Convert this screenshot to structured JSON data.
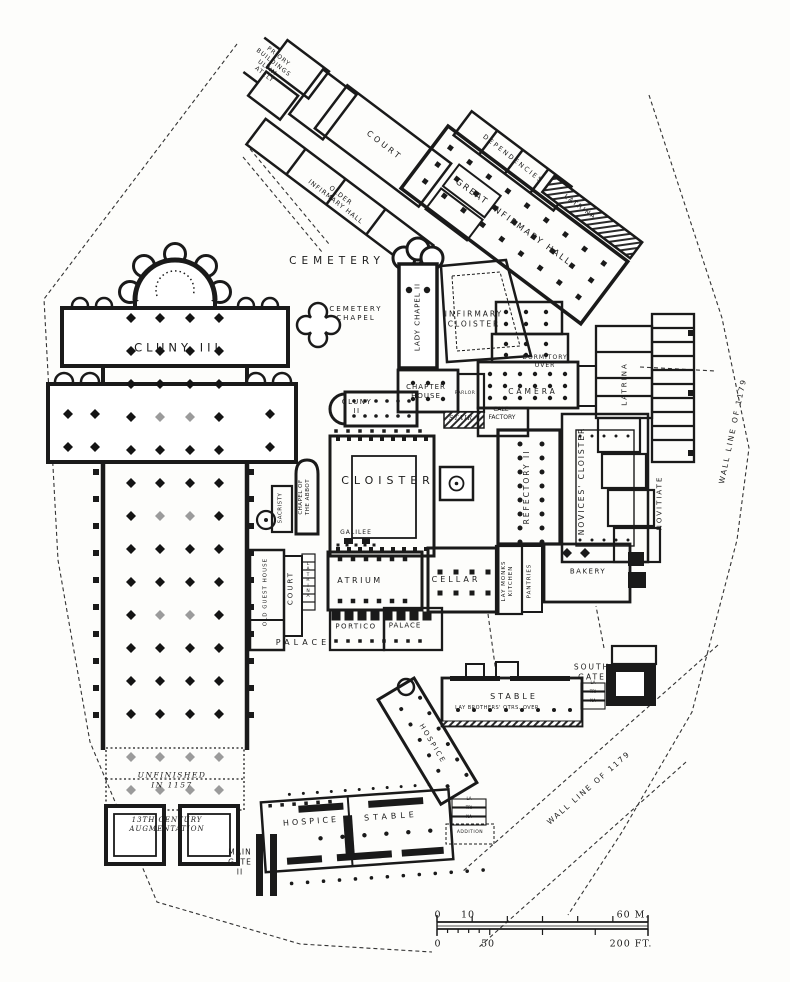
{
  "plan": {
    "type": "monastic site plan (engraved line drawing)",
    "ink_color": "#1a1a1a",
    "paper_color": "#fdfdfb"
  },
  "labels": [
    {
      "name": "priory-buildings",
      "text": "PRIORY\nBUILDINGS\nULTIM-\nATELY",
      "x": 271,
      "y": 66,
      "rot": 38,
      "size": 6,
      "ls": 1
    },
    {
      "name": "court-top",
      "text": "COURT",
      "x": 384,
      "y": 146,
      "rot": 38,
      "size": 8,
      "ls": 3
    },
    {
      "name": "older-infirmary-hall",
      "text": "OLDER\nINFIRMARY HALL",
      "x": 338,
      "y": 199,
      "rot": 38,
      "size": 6.5,
      "ls": 1
    },
    {
      "name": "dependencies",
      "text": "DEPENDENCIES",
      "x": 513,
      "y": 159,
      "rot": 38,
      "size": 6.5,
      "ls": 2
    },
    {
      "name": "latrina-top",
      "text": "LATRINA",
      "x": 580,
      "y": 207,
      "rot": 36,
      "size": 6.5,
      "ls": 1.5
    },
    {
      "name": "great-infirmary-hall",
      "text": "GREAT INFIRMARY HALL",
      "x": 513,
      "y": 223,
      "rot": 36,
      "size": 8.5,
      "ls": 2
    },
    {
      "name": "cemetery",
      "text": "CEMETERY",
      "x": 337,
      "y": 262,
      "rot": 0,
      "size": 10.5,
      "ls": 5
    },
    {
      "name": "cemetery-chapel",
      "text": "CEMETERY\nCHAPEL",
      "x": 356,
      "y": 314,
      "rot": 0,
      "size": 7,
      "ls": 2
    },
    {
      "name": "lady-chapel-ii",
      "text": "LADY CHAPEL II",
      "x": 418,
      "y": 317,
      "rot": -90,
      "size": 7,
      "ls": 1
    },
    {
      "name": "infirmary-cloister",
      "text": "INFIRMARY\nCLOISTER",
      "x": 474,
      "y": 319,
      "rot": 0,
      "size": 7.5,
      "ls": 2
    },
    {
      "name": "dormitory-over",
      "text": "DORMITORY\nOVER",
      "x": 545,
      "y": 362,
      "rot": 0,
      "size": 6,
      "ls": 1
    },
    {
      "name": "camera",
      "text": "CAMERA",
      "x": 533,
      "y": 392,
      "rot": 0,
      "size": 7.5,
      "ls": 3
    },
    {
      "name": "latrina-east",
      "text": "LATRINA",
      "x": 625,
      "y": 384,
      "rot": -90,
      "size": 7,
      "ls": 2
    },
    {
      "name": "cluny-iii",
      "text": "CLUNY III",
      "x": 178,
      "y": 348,
      "rot": 0,
      "size": 11.5,
      "ls": 4
    },
    {
      "name": "cluny-ii",
      "text": "CLUNY\nII",
      "x": 357,
      "y": 407,
      "rot": 0,
      "size": 7,
      "ls": 1.5
    },
    {
      "name": "chapter-house",
      "text": "CHAPTER\nHOUSE",
      "x": 426,
      "y": 392,
      "rot": 0,
      "size": 7,
      "ls": 1
    },
    {
      "name": "parlor",
      "text": "PARLOR",
      "x": 465,
      "y": 394,
      "rot": 0,
      "size": 4.5,
      "ls": 0.5
    },
    {
      "name": "stair",
      "text": "STAIR",
      "x": 461,
      "y": 419,
      "rot": 0,
      "size": 6,
      "ls": 1,
      "italic": true
    },
    {
      "name": "calefactory",
      "text": "CALE-\nFACTORY",
      "x": 502,
      "y": 414,
      "rot": 0,
      "size": 6,
      "ls": 0
    },
    {
      "name": "cloister",
      "text": "CLOISTER",
      "x": 388,
      "y": 481,
      "rot": 0,
      "size": 11,
      "ls": 5
    },
    {
      "name": "refectory-ii",
      "text": "REFECTORY II",
      "x": 527,
      "y": 487,
      "rot": -90,
      "size": 7.5,
      "ls": 2
    },
    {
      "name": "novices-cloister",
      "text": "NOVICES' CLOISTER",
      "x": 582,
      "y": 481,
      "rot": -90,
      "size": 7.5,
      "ls": 2
    },
    {
      "name": "novitiate",
      "text": "NOVITIATE",
      "x": 660,
      "y": 503,
      "rot": -90,
      "size": 7,
      "ls": 2
    },
    {
      "name": "sacristy",
      "text": "SACRISTY",
      "x": 281,
      "y": 508,
      "rot": -90,
      "size": 5.5,
      "ls": 0.5
    },
    {
      "name": "chapel-of-the-abbot",
      "text": "CHAPEL OF\nTHE ABBOT",
      "x": 305,
      "y": 497,
      "rot": -90,
      "size": 5.5,
      "ls": 0.5
    },
    {
      "name": "galilee",
      "text": "GALILEE",
      "x": 356,
      "y": 533,
      "rot": 0,
      "size": 6,
      "ls": 1
    },
    {
      "name": "atrium",
      "text": "ATRIUM",
      "x": 360,
      "y": 581,
      "rot": 0,
      "size": 8,
      "ls": 2.5
    },
    {
      "name": "cellar",
      "text": "CELLAR",
      "x": 456,
      "y": 580,
      "rot": 0,
      "size": 8,
      "ls": 3
    },
    {
      "name": "lay-monks-kitchen",
      "text": "LAY MONKS\nKITCHEN",
      "x": 508,
      "y": 581,
      "rot": -90,
      "size": 5.5,
      "ls": 1
    },
    {
      "name": "pantries",
      "text": "PANTRIES",
      "x": 530,
      "y": 581,
      "rot": -90,
      "size": 5.5,
      "ls": 1
    },
    {
      "name": "bakery",
      "text": "BAKERY",
      "x": 588,
      "y": 572,
      "rot": 0,
      "size": 7,
      "ls": 1.5
    },
    {
      "name": "old-guest-house",
      "text": "OLD GUEST HOUSE",
      "x": 266,
      "y": 592,
      "rot": -90,
      "size": 5.5,
      "ls": 1
    },
    {
      "name": "court-west",
      "text": "COURT",
      "x": 291,
      "y": 588,
      "rot": -90,
      "size": 7,
      "ls": 2
    },
    {
      "name": "latrina-court",
      "text": "L\nA\nT\nR\nI\nN\nA",
      "x": 308,
      "y": 581,
      "rot": 0,
      "size": 4.5,
      "ls": 0,
      "lh": 1.2
    },
    {
      "name": "portico",
      "text": "PORTICO",
      "x": 356,
      "y": 627,
      "rot": 0,
      "size": 7,
      "ls": 1.5
    },
    {
      "name": "palace-room",
      "text": "PALACE",
      "x": 405,
      "y": 626,
      "rot": 0,
      "size": 7,
      "ls": 1
    },
    {
      "name": "palace",
      "text": "PALACE",
      "x": 303,
      "y": 643,
      "rot": 0,
      "size": 8,
      "ls": 4
    },
    {
      "name": "south-gate",
      "text": "SOUTH\nGATE",
      "x": 592,
      "y": 672,
      "rot": 0,
      "size": 7.5,
      "ls": 2
    },
    {
      "name": "stable-south",
      "text": "STABLE",
      "x": 514,
      "y": 697,
      "rot": 0,
      "size": 8,
      "ls": 3
    },
    {
      "name": "lay-brothers-qtrs",
      "text": "LAY BROTHERS' QTRS. OVER",
      "x": 497,
      "y": 708,
      "rot": 0,
      "size": 5,
      "ls": 0.5
    },
    {
      "name": "latrina-south-gate",
      "text": "LA\nTRI\nNA",
      "x": 593,
      "y": 692,
      "rot": 0,
      "size": 4,
      "ls": 0,
      "lh": 2.2
    },
    {
      "name": "hospice-upper",
      "text": "HOSPICE",
      "x": 432,
      "y": 744,
      "rot": 59,
      "size": 7,
      "ls": 2
    },
    {
      "name": "unfinished-1157",
      "text": "UNFINISHED\nIN 1157",
      "x": 172,
      "y": 780,
      "rot": 0,
      "size": 7.5,
      "ls": 1.5,
      "italic": true
    },
    {
      "name": "augmentation",
      "text": "13TH CENTURY\nAUGMENTATION",
      "x": 167,
      "y": 825,
      "rot": 0,
      "size": 7,
      "ls": 1,
      "italic": true
    },
    {
      "name": "main-gate-ii",
      "text": "MAIN\nGATE\nII",
      "x": 240,
      "y": 862,
      "rot": 0,
      "size": 7.5,
      "ls": 1
    },
    {
      "name": "hospice-lower",
      "text": "HOSPICE",
      "x": 311,
      "y": 822,
      "rot": -4,
      "size": 8,
      "ls": 3
    },
    {
      "name": "stable-lower",
      "text": "STABLE",
      "x": 391,
      "y": 817,
      "rot": -4,
      "size": 8,
      "ls": 4
    },
    {
      "name": "latrina-stable",
      "text": "LA\nTRI\nNA",
      "x": 469,
      "y": 808,
      "rot": 0,
      "size": 4,
      "ls": 0,
      "lh": 2.2
    },
    {
      "name": "addition",
      "text": "ADDITION",
      "x": 470,
      "y": 833,
      "rot": 0,
      "size": 4.5,
      "ls": 0.5
    },
    {
      "name": "wall-line-1179-east",
      "text": "WALL LINE OF 1179",
      "x": 733,
      "y": 431,
      "rot": -78,
      "size": 7.5,
      "ls": 2
    },
    {
      "name": "wall-line-1179-south",
      "text": "WALL LINE OF 1179",
      "x": 589,
      "y": 788,
      "rot": -41,
      "size": 7.5,
      "ls": 2
    }
  ],
  "scale_bar": {
    "metric": {
      "zero": "0",
      "ten": "10",
      "max": "60 M."
    },
    "imperial": {
      "zero": "0",
      "fifty": "50",
      "max": "200 FT."
    }
  }
}
